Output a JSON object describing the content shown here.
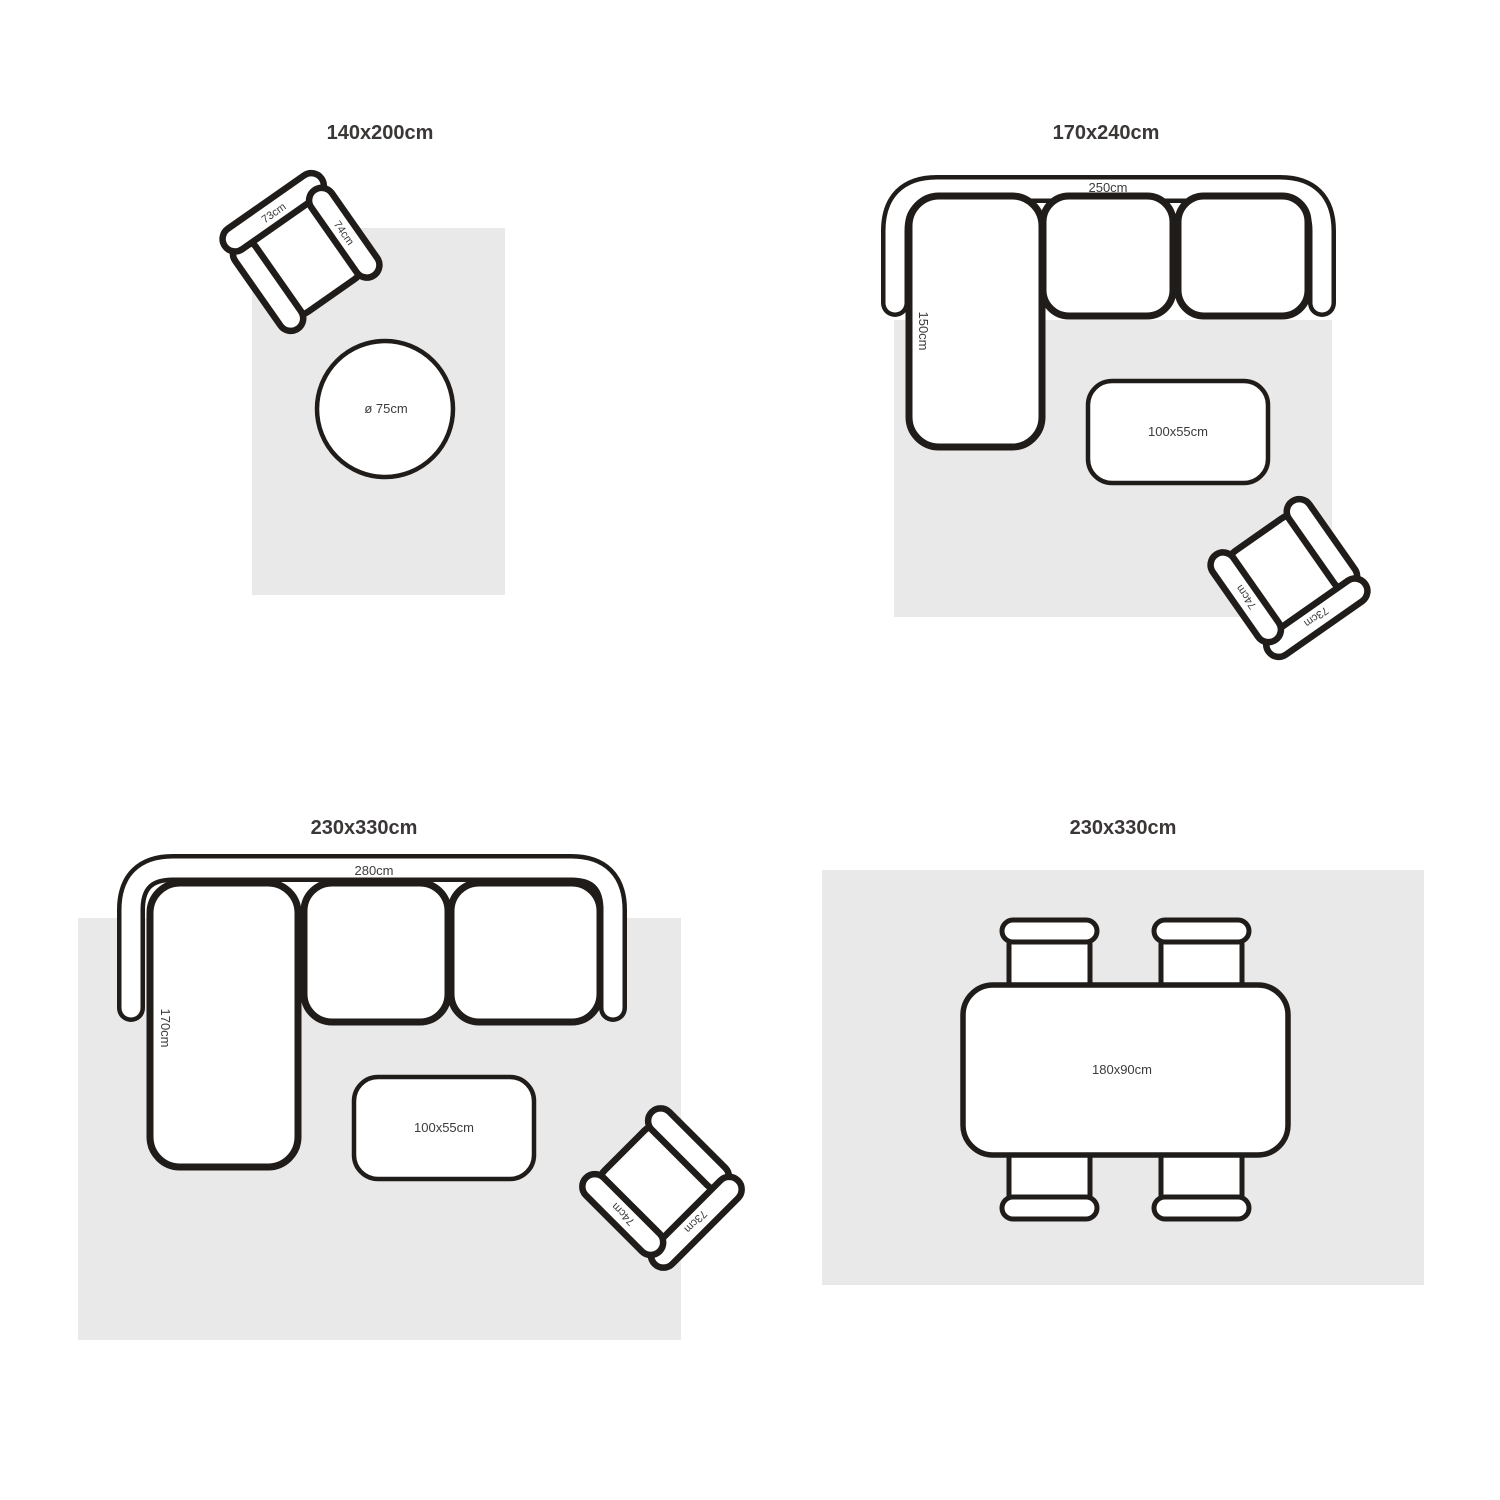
{
  "colors": {
    "outline": "#1f1c1a",
    "rug": "#e9e9e9",
    "label": "#3e3c3a",
    "title": "#3a3736",
    "furniture": "#ffffff",
    "background": "#ffffff"
  },
  "panels": [
    {
      "title": "140x200cm",
      "armchair": {
        "back_label": "73cm",
        "side_label": "74cm"
      },
      "side_table": {
        "diameter_label": "ø 75cm"
      }
    },
    {
      "title": "170x240cm",
      "sofa": {
        "width_label": "250cm",
        "depth_label": "150cm"
      },
      "coffee_table": {
        "size_label": "100x55cm"
      },
      "armchair": {
        "back_label": "73cm",
        "side_label": "74cm"
      }
    },
    {
      "title": "230x330cm",
      "sofa": {
        "width_label": "280cm",
        "depth_label": "170cm"
      },
      "coffee_table": {
        "size_label": "100x55cm"
      },
      "armchair": {
        "back_label": "73cm",
        "side_label": "74cm"
      }
    },
    {
      "title": "230x330cm",
      "dining_table": {
        "size_label": "180x90cm",
        "chairs": 4
      }
    }
  ]
}
